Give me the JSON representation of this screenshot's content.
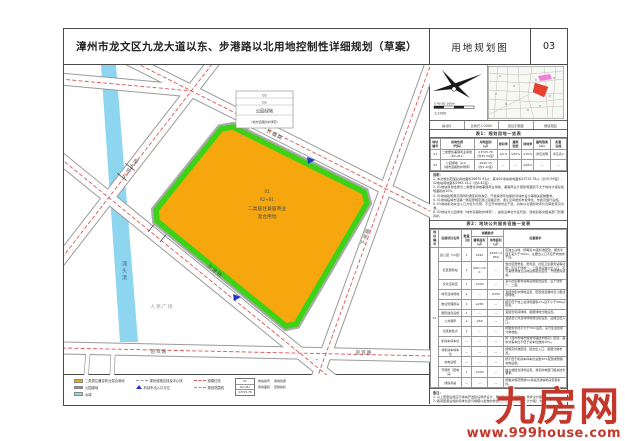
{
  "colors": {
    "parcel_orange": "#f6a70e",
    "green_belt": "#3cd316",
    "water": "#8ed5f0",
    "road_centerline_red": "#dd5555",
    "boundary_magenta": "#e566d0",
    "watermark_red": "#c4382c"
  },
  "header": {
    "title": "漳州市龙文区九龙大道以东、步港路以北用地控制性详细规划（草案）",
    "sheet_name": "用地规划图",
    "sheet_no": "03"
  },
  "map": {
    "river": "浦头港",
    "poi": "人民广场",
    "roads": {
      "jiulong": "九龙大道",
      "changfu": "长福路",
      "xiazhou": "下洲路",
      "bugang": "步港路",
      "yingbin1": "迎宾路",
      "yingbin2": "迎宾路"
    },
    "callout": {
      "l1": "02",
      "l2": "G1",
      "l3": "公园绿地",
      "l4": "（城市道路防护绿带）"
    },
    "parcel": {
      "l1": "01",
      "l2": "R2+B1",
      "l3": "二类居住兼容商业",
      "l4": "混合用地"
    }
  },
  "compass": {
    "scale_ticks": "0  40  80  160m",
    "scale_label": "1:2000"
  },
  "legend": {
    "fill": [
      {
        "color": "#f6a70e",
        "label": "二类居住兼容商业混合用地"
      },
      {
        "color": "#3cd316",
        "label": "公园绿地"
      },
      {
        "color": "#8ed5f0",
        "label": "水域"
      }
    ],
    "line": [
      {
        "label": "现状道路边线及中心线"
      },
      {
        "label": "机动车出入口方位"
      }
    ],
    "bound": [
      {
        "color": "#dd5555",
        "label": "道路红线"
      },
      {
        "color": "#e566d0",
        "label": "规划范围线"
      }
    ],
    "key": {
      "l1": "01",
      "l2": "R2+B1",
      "l3": "23725.78"
    },
    "key_labels": [
      "地块编号",
      "用地性质",
      "用地面积",
      "控制指标"
    ]
  },
  "panel": {
    "info_cells": [
      "指北针",
      "比例尺 1:2000",
      "区位示意图",
      "规划范围"
    ],
    "table1": {
      "title": "表1：规划用地一览表",
      "headers": [
        "地块\n编号",
        "用地性质\n（代码）",
        "用地面积\n（㎡）",
        "容积率",
        "建筑\n密度",
        "绿地率",
        "建筑限高\n（m）",
        "配套\n设施"
      ],
      "rows": [
        [
          "01",
          "二类居住兼容商业用地（R2+B1）",
          "23725.78\n（约35.59亩）",
          "≤2.8",
          "≤30%",
          "≥30%",
          "详见说明",
          "详见表2"
        ],
        [
          "02",
          "公园绿地（G1）\n（城市道路防护绿带）",
          "2945.15\n（约4.42亩）",
          "—",
          "—",
          "≥65%",
          "—",
          "—"
        ]
      ]
    },
    "notes": {
      "heading": "说明：",
      "items": [
        "1. 本次规划范围总用地面积26670.93㎡，其中01地块用地面积23725.78㎡（约35.59亩），02地块用地面积2945.15㎡（约4.42亩）。",
        "2. 01地块用地性质为二类居住用地兼容商业用地，兼容商业计容建筑面积不大于地块计容总建筑面积的10%。",
        "3. 01地块建筑限高须同时满足机场净空、气象探测环境保护及城市设计等相关控制要求。",
        "4. 01地块临城市道路一侧应按规定退让道路红线，退让空间统筹布置绿化、市政及慢行设施。",
        "5. 01地块机动车出入口方位为示意，不应开向城市主干道，具体以交通影响评价及审批意见为准。",
        "6. 02地块为公园绿地（城市道路防护绿带），由建设单位代征代建，建成后移交相关部门管理养护。"
      ]
    },
    "table2": {
      "title": "表2：地块公共服务设施一览表",
      "group_header": "规模要求",
      "headers": [
        "地块\n编号",
        "设施项目名称",
        "数量\n（处）",
        "建筑面积\n（㎡）",
        "用地面积\n（㎡）",
        "设置要求"
      ],
      "block_no": "01",
      "rows": [
        {
          "name": "幼儿园（12班）",
          "qty": "1",
          "jz": "3240",
          "yd": "4320～4860",
          "req": "应独立占地，按每班30座标准配建，服务半径不宜大于300m，主要出入口不应开向城市干道。"
        },
        {
          "name": "社区服务站",
          "qty": "1",
          "jz": "600～700",
          "yd": "—",
          "req": "含社区居委会、警务室、社区卫生服务站等功能；应设于建筑一、二层并设独立出入口，可与其他非独立占地设施组合设置，方便居民使用。"
        },
        {
          "name": "文化活动室",
          "qty": "1",
          "jz": "≥200",
          "yd": "—",
          "req": "宜与社区服务站等设施组合设置，设于建筑一、二层。"
        },
        {
          "name": "体育活动场地",
          "qty": "1",
          "jz": "—",
          "yd": "≥300",
          "req": "宜结合集中绿地设置，配置健身器材及儿童活动场地。"
        },
        {
          "name": "物业管理用房",
          "qty": "1",
          "jz": "≥280",
          "yd": "—",
          "req": "按不低于地上总建筑面积2‰且不小于280㎡配置。"
        },
        {
          "name": "居民健身设施",
          "qty": "1",
          "jz": "—",
          "yd": "—",
          "req": "宜结合宅间绿地、组团绿地分散设置。"
        },
        {
          "name": "公共厕所",
          "qty": "1",
          "jz": "≥60",
          "yd": "—",
          "req": "宜结合公共活动场地或沿街设置，设独立出入口。"
        },
        {
          "name": "垃圾收集点",
          "qty": "1",
          "jz": "—",
          "yd": "—",
          "req": "按服务半径不大于70m设置，实行生活垃圾分类收集。"
        },
        {
          "name": "机动车停车位",
          "qty": "—",
          "jz": "—",
          "yd": "—",
          "req": "按《漳州市城市规划管理技术规定》配建，其中访客车位不低于总车位数的10%。"
        },
        {
          "name": "非机动车停车位",
          "qty": "—",
          "jz": "—",
          "yd": "—",
          "req": "按规定标准配建，结合出入口、组团分散布置。"
        },
        {
          "name": "充电设施",
          "qty": "—",
          "jz": "—",
          "yd": "—",
          "req": "按不低于机动车停车位总数30%配建或预留充电设施。"
        },
        {
          "name": "开闭所（配电房）",
          "qty": "1",
          "jz": "≥200",
          "yd": "—",
          "req": "独立或结合建筑设置，满足供电部门相关技术要求。"
        },
        {
          "name": "通信基站",
          "qty": "—",
          "jz": "—",
          "yd": "—",
          "req": "按相关规范预留5G基站及通信机房安装条件。"
        }
      ]
    },
    "remarks": {
      "heading": "备注：",
      "items": [
        "1. 以上配套设施应与地块开发建设同步设计、同步建设、同步验收、同步交付使用。",
        "2. 各项配套设施的具体位置与规模以批准的修建性详细规划（建筑设计方案）为准。"
      ]
    }
  },
  "watermark": {
    "name": "九房网",
    "url": "www.999house.com"
  }
}
